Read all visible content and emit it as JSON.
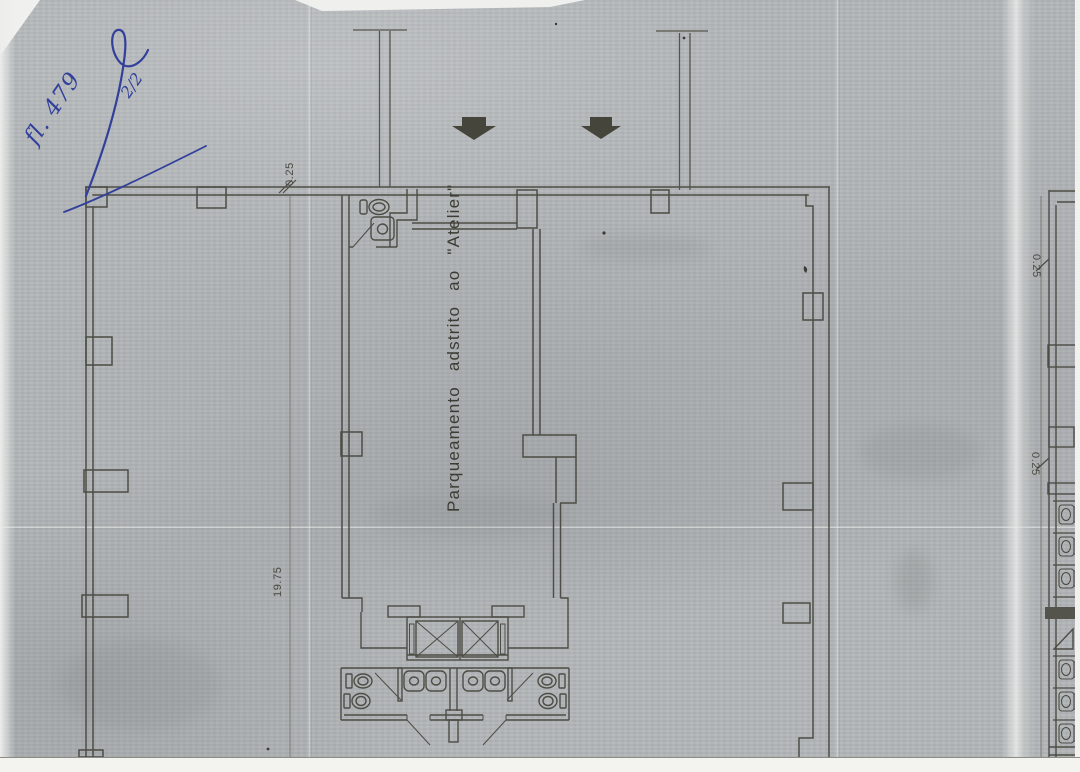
{
  "document": {
    "kind": "scanned architectural floor plan"
  },
  "annotations": {
    "sheet_note": "fl. 479",
    "page_fraction": "2/2"
  },
  "plan": {
    "parking_label": "Parqueamento adstrito ao \"Atelier\"",
    "dimensions": {
      "top_left": "0.25",
      "left_height": "19.75",
      "right_upper": "0.25",
      "right_lower": "0.25"
    }
  },
  "colors": {
    "paper": "#b2b6b8",
    "ink": "#4d4c45",
    "arrow": "#45453c",
    "handwriting": "#33409b",
    "scan_edge": "#f3f3ef"
  }
}
